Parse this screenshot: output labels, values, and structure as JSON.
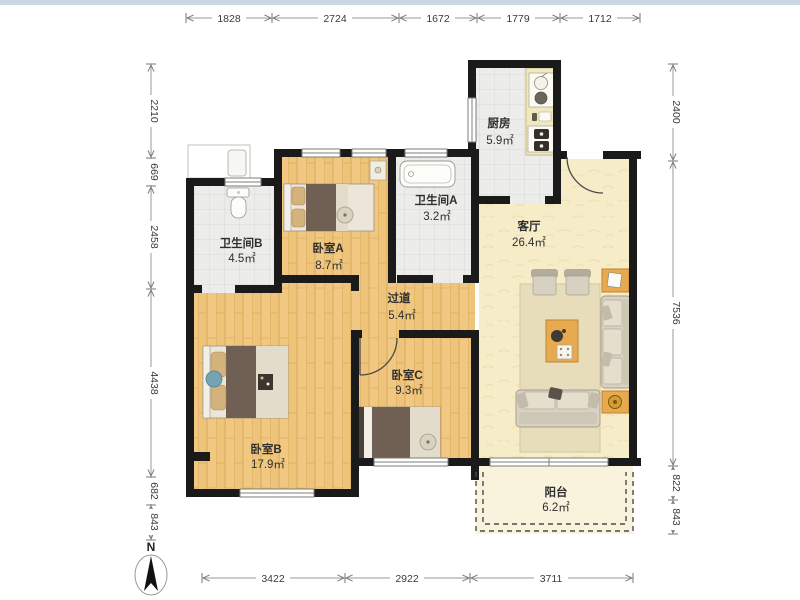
{
  "page": {
    "top_strip_color": "#cdd7e2",
    "background": "#ffffff"
  },
  "rooms": [
    {
      "id": "bathroom-b",
      "name": "卫生间B",
      "area": "4.5㎡"
    },
    {
      "id": "bedroom-a",
      "name": "卧室A",
      "area": "8.7㎡"
    },
    {
      "id": "bathroom-a",
      "name": "卫生间A",
      "area": "3.2㎡"
    },
    {
      "id": "kitchen",
      "name": "厨房",
      "area": "5.9㎡"
    },
    {
      "id": "living-room",
      "name": "客厅",
      "area": "26.4㎡"
    },
    {
      "id": "hallway",
      "name": "过道",
      "area": "5.4㎡"
    },
    {
      "id": "bedroom-b",
      "name": "卧室B",
      "area": "17.9㎡"
    },
    {
      "id": "bedroom-c",
      "name": "卧室C",
      "area": "9.3㎡"
    },
    {
      "id": "balcony",
      "name": "阳台",
      "area": "6.2㎡"
    }
  ],
  "dimensions": {
    "top": [
      "1828",
      "2724",
      "1672",
      "1779",
      "1712"
    ],
    "left": [
      "2210",
      "669",
      "2458",
      "4438",
      "682",
      "843"
    ],
    "right": [
      "2400",
      "7536",
      "822",
      "843"
    ],
    "bottom": [
      "3422",
      "2922",
      "3711"
    ]
  },
  "compass": {
    "north_label": "N"
  },
  "colors": {
    "wall": "#1a1a1a",
    "wood_floor": "#eec47b",
    "tile_floor": "#ececea",
    "living_floor": "#f6ecc8",
    "balcony_floor": "#f9f2dc",
    "furniture_accent": "#e7aa4e",
    "dark_fabric": "#6f6053"
  }
}
